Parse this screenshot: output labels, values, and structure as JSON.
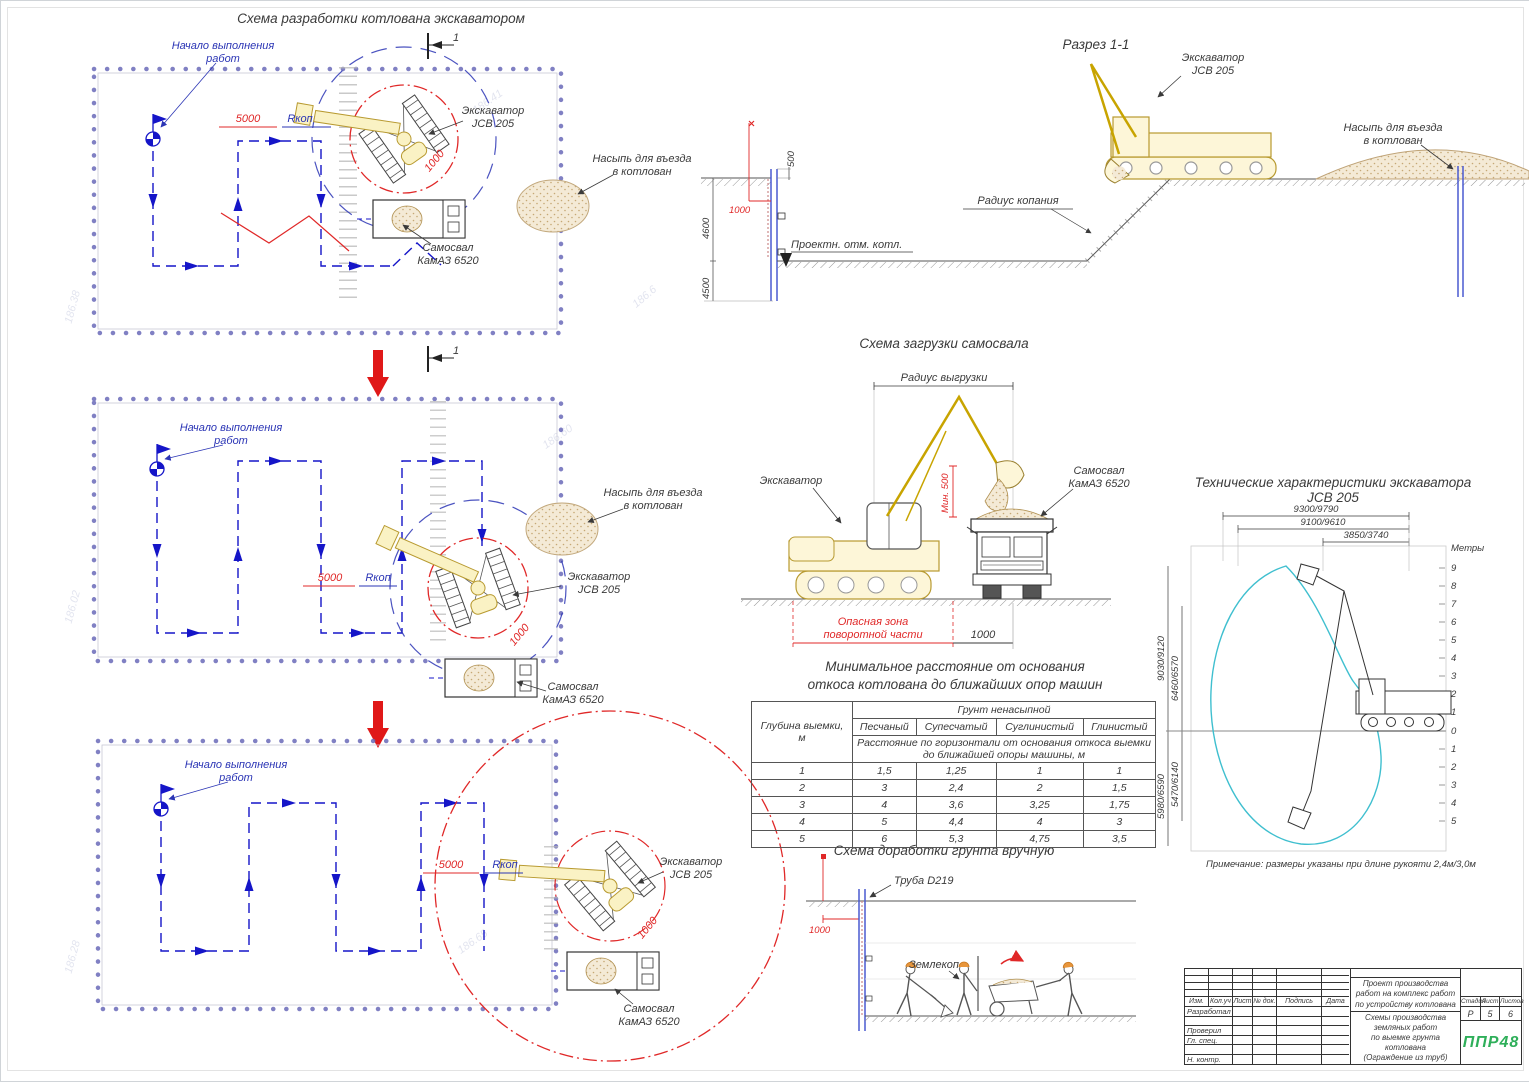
{
  "colors": {
    "accent_blue": "#2b35b5",
    "drawing_blue": "#1515c8",
    "danger_red": "#e02828",
    "machine_yellow": "#c9a227",
    "envelope_teal": "#3fbfcf",
    "sand": "#d8c09a",
    "logo_green": "#2faf5a"
  },
  "plan": {
    "title": "Схема разработки котлована экскаватором",
    "start_line1": "Начало выполнения",
    "start_line2": "работ",
    "section_mark": "1"
  },
  "labels": {
    "excavator": "Экскаватор",
    "model": "JCB 205",
    "truck": "Самосвал",
    "truck_model": "КамАЗ 6520",
    "mound1": "Насыпь для въезда",
    "mound2": "в котлован"
  },
  "dims": {
    "d5000": "5000",
    "rkop": "Rкоп",
    "d1000": "1000"
  },
  "section": {
    "title": "Разрез 1-1",
    "radius_label": "Радиус копания",
    "level_label": "Проектн. отм. котл.",
    "d500": "500",
    "d4600": "4600",
    "d4500": "4500",
    "d1000": "1000"
  },
  "loading": {
    "title": "Схема загрузки самосвала",
    "radius_label": "Радиус выгрузки",
    "min_label": "Мин. 500",
    "danger_line1": "Опасная зона",
    "danger_line2": "поворотной части",
    "d1000": "1000"
  },
  "min_table": {
    "title_line1": "Минимальное расстояние от основания",
    "title_line2": "откоса котлована до ближайших опор машин",
    "depth_line1": "Глубина выемки,",
    "depth_line2": "м",
    "group_header": "Грунт ненасыпной",
    "soils": [
      "Песчаный",
      "Супесчатый",
      "Суглинистый",
      "Глинистый"
    ],
    "sub_header": "Расстояние по горизонтали от основания откоса выемки до ближайшей опоры машины, м",
    "rows": [
      [
        "1",
        "1,5",
        "1,25",
        "1",
        "1"
      ],
      [
        "2",
        "3",
        "2,4",
        "2",
        "1,5"
      ],
      [
        "3",
        "4",
        "3,6",
        "3,25",
        "1,75"
      ],
      [
        "4",
        "5",
        "4,4",
        "4",
        "3"
      ],
      [
        "5",
        "6",
        "5,3",
        "4,75",
        "3,5"
      ]
    ]
  },
  "manual": {
    "title": "Схема доработки грунта вручную",
    "pipe_label": "Труба D219",
    "d1000": "1000",
    "worker_label": "Землекоп"
  },
  "tech": {
    "title_line1": "Технические характеристики экскаватора",
    "title_line2": "JCB 205",
    "dim_top": [
      "9300/9790",
      "9100/9610",
      "3850/3740"
    ],
    "dim_left": [
      "9030/9120",
      "6460/6570",
      "5980/6590",
      "5470/6140"
    ],
    "scale_unit": "Метры",
    "scale_above": [
      "9",
      "8",
      "7",
      "6",
      "5",
      "4",
      "3",
      "2",
      "1",
      "0"
    ],
    "scale_below": [
      "1",
      "2",
      "3",
      "4",
      "5"
    ],
    "note": "Примечание: размеры указаны при длине рукояти 2,4м/3,0м"
  },
  "titleblock": {
    "header_cols": [
      "Изм.",
      "Кол.уч",
      "Лист",
      "№ док.",
      "Подпись",
      "Дата"
    ],
    "row_labels": [
      "Разработал",
      "",
      "Проверил",
      "Гл. спец.",
      "",
      "Н. контр."
    ],
    "doc_title": "Проект производства работ на комплекс работ по устройству котлована",
    "sheet_line1": "Схемы производства земляных работ",
    "sheet_line2": "по выемке грунта котлована",
    "sheet_line3": "(Ограждение из труб)",
    "stage_label": "Стадия",
    "sheet_label": "Лист",
    "sheets_label": "Листов",
    "stage": "Р",
    "sheet": "5",
    "sheets": "6",
    "logo": "ППР48"
  },
  "topo": [
    "186.41",
    "186.6",
    "186.60",
    "186.02",
    "186.65",
    "186.28",
    "186.38"
  ]
}
